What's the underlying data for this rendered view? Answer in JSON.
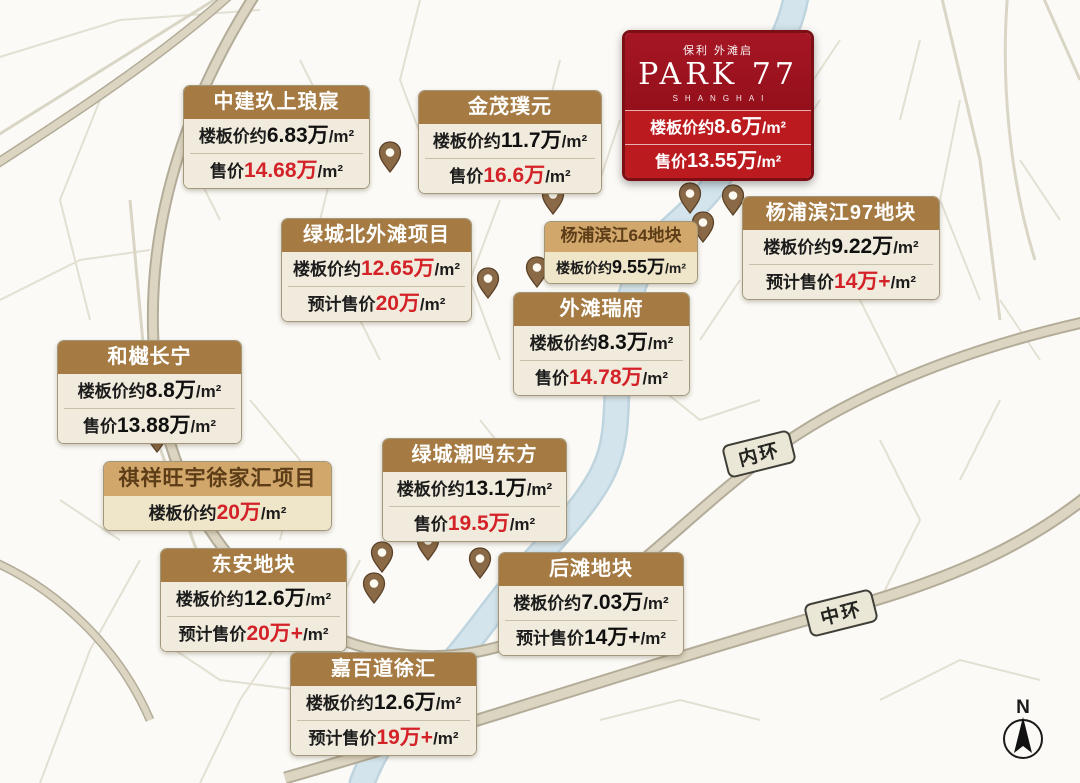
{
  "colors": {
    "accent_red": "#d42328",
    "park77_red_top": "#a61624",
    "park77_red_bottom": "#bb1a1f",
    "header_brown": "#a57b43",
    "header_tan": "#d2a76b",
    "pin_brown": "#8a6947",
    "river_blue": "#cfe1ea",
    "road_beige": "#dbd5c1"
  },
  "park77": {
    "brand_small": "保利 外滩启",
    "brand_name": "PARK 77",
    "brand_sub": "SHANGHAI",
    "rows": [
      {
        "label": "楼板价约",
        "value": "8.6万",
        "unit": "/m²"
      },
      {
        "label": "售价",
        "value": "13.55万",
        "unit": "/m²"
      }
    ]
  },
  "projects": [
    {
      "name": "中建玖上琅宸",
      "rows": [
        {
          "label": "楼板价约",
          "value": "6.83万",
          "unit": "/m²",
          "red": false
        },
        {
          "label": "售价",
          "value": "14.68万",
          "unit": "/m²",
          "red": true
        }
      ]
    },
    {
      "name": "金茂璞元",
      "rows": [
        {
          "label": "楼板价约",
          "value": "11.7万",
          "unit": "/m²",
          "red": false
        },
        {
          "label": "售价",
          "value": "16.6万",
          "unit": "/m²",
          "red": true
        }
      ]
    },
    {
      "name": "杨浦滨江64地块",
      "rows": [
        {
          "label": "楼板价约",
          "value": "9.55万",
          "unit": "/m²",
          "red": false
        }
      ]
    },
    {
      "name": "杨浦滨江97地块",
      "rows": [
        {
          "label": "楼板价约",
          "value": "9.22万",
          "unit": "/m²",
          "red": false
        },
        {
          "label": "预计售价",
          "value": "14万+",
          "unit": "/m²",
          "red": true
        }
      ]
    },
    {
      "name": "绿城北外滩项目",
      "rows": [
        {
          "label": "楼板价约",
          "value": "12.65万",
          "unit": "/m²",
          "red": true
        },
        {
          "label": "预计售价",
          "value": "20万",
          "unit": "/m²",
          "red": true
        }
      ]
    },
    {
      "name": "外滩瑞府",
      "rows": [
        {
          "label": "楼板价约",
          "value": "8.3万",
          "unit": "/m²",
          "red": false
        },
        {
          "label": "售价",
          "value": "14.78万",
          "unit": "/m²",
          "red": true
        }
      ]
    },
    {
      "name": "和樾长宁",
      "rows": [
        {
          "label": "楼板价约",
          "value": "8.8万",
          "unit": "/m²",
          "red": false
        },
        {
          "label": "售价",
          "value": "13.88万",
          "unit": "/m²",
          "red": false
        }
      ]
    },
    {
      "name": "祺祥旺宇徐家汇项目",
      "rows": [
        {
          "label": "楼板价约",
          "value": "20万",
          "unit": "/m²",
          "red": true
        }
      ]
    },
    {
      "name": "绿城潮鸣东方",
      "rows": [
        {
          "label": "楼板价约",
          "value": "13.1万",
          "unit": "/m²",
          "red": false
        },
        {
          "label": "售价",
          "value": "19.5万",
          "unit": "/m²",
          "red": true
        }
      ]
    },
    {
      "name": "东安地块",
      "rows": [
        {
          "label": "楼板价约",
          "value": "12.6万",
          "unit": "/m²",
          "red": false
        },
        {
          "label": "预计售价",
          "value": "20万+",
          "unit": "/m²",
          "red": true
        }
      ]
    },
    {
      "name": "后滩地块",
      "rows": [
        {
          "label": "楼板价约",
          "value": "7.03万",
          "unit": "/m²",
          "red": false
        },
        {
          "label": "预计售价",
          "value": "14万+",
          "unit": "/m²",
          "red": false
        }
      ]
    },
    {
      "name": "嘉百道徐汇",
      "rows": [
        {
          "label": "楼板价约",
          "value": "12.6万",
          "unit": "/m²",
          "red": false
        },
        {
          "label": "预计售价",
          "value": "19万+",
          "unit": "/m²",
          "red": true
        }
      ]
    }
  ],
  "map": {
    "road_labels": [
      {
        "text": "内环"
      },
      {
        "text": "中环"
      }
    ],
    "compass_label": "N"
  }
}
